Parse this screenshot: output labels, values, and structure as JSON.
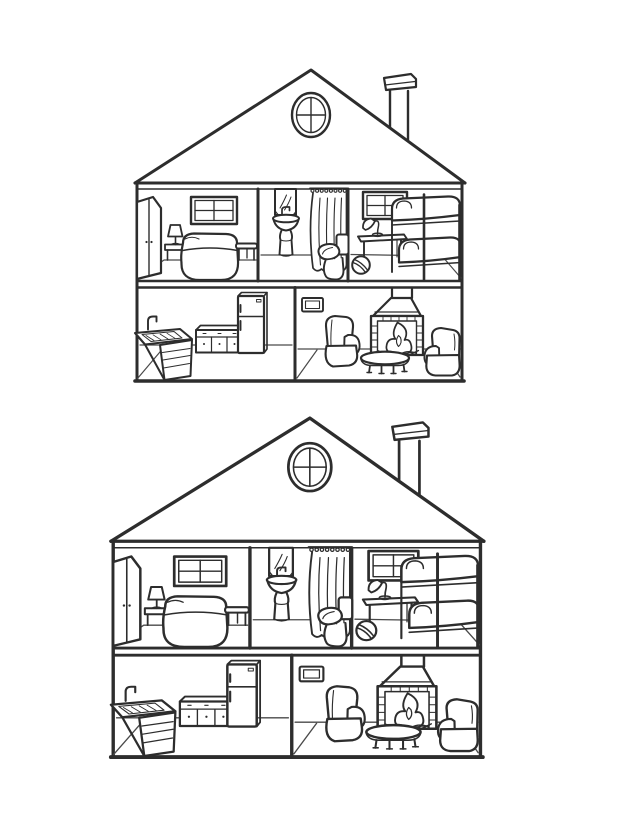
{
  "scene": {
    "style": "black-and-white line-art coloring page",
    "background_color": "#ffffff",
    "line_color": "#2d2d2d",
    "figure_count": 2,
    "figures": [
      {
        "id": "dollhouse-small",
        "position": "top",
        "alt": "Cutaway two-story dollhouse with gable roof, round attic window and chimney"
      },
      {
        "id": "dollhouse-large",
        "position": "bottom",
        "alt": "Larger copy of the same cutaway two-story dollhouse"
      }
    ],
    "house": {
      "exterior": [
        "gable roof",
        "round attic window with cross muntins",
        "chimney with cap"
      ],
      "rooms": [
        {
          "name": "bedroom",
          "floor": "upper",
          "furniture": [
            "wardrobe",
            "four-pane window",
            "nightstand",
            "table lamp",
            "double bed",
            "bench"
          ]
        },
        {
          "name": "bathroom",
          "floor": "upper",
          "furniture": [
            "mirror",
            "pedestal sink with faucet",
            "shower curtain with rings",
            "toilet"
          ]
        },
        {
          "name": "kids-bedroom",
          "floor": "upper",
          "furniture": [
            "four-pane window",
            "desk",
            "desk lamp",
            "striped ball",
            "bunk bed"
          ]
        },
        {
          "name": "kitchen",
          "floor": "lower",
          "furniture": [
            "corner sink counter with faucet",
            "lower cabinets with knobs",
            "refrigerator"
          ]
        },
        {
          "name": "living-room",
          "floor": "lower",
          "furniture": [
            "wall vent frame",
            "fireplace with burning fire",
            "armchair left",
            "armchair right",
            "oval coffee table"
          ]
        }
      ]
    }
  }
}
